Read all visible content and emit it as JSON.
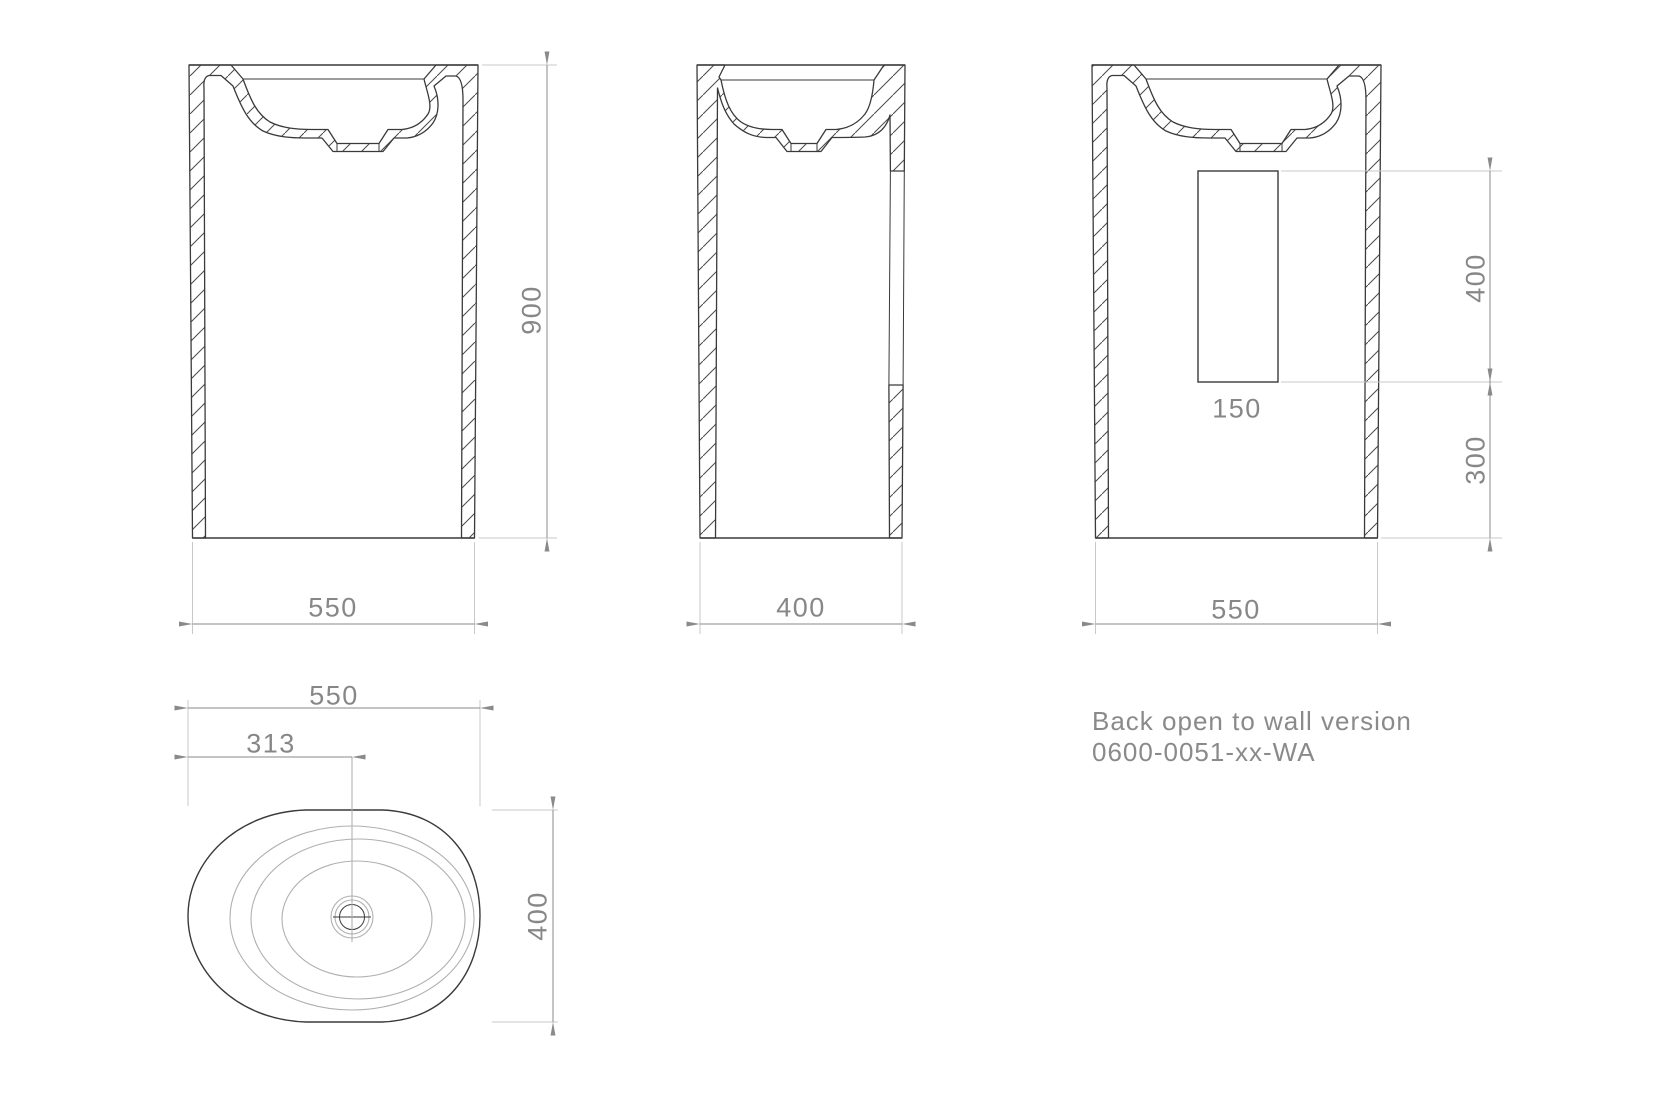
{
  "drawing": {
    "note": {
      "line1": "Back open to wall version",
      "line2": "0600-0051-xx-WA"
    },
    "views": {
      "front_elevation": {
        "width_label": "550",
        "height_label": "900"
      },
      "side_elevation": {
        "depth_label": "400"
      },
      "back_elevation": {
        "width_label": "550",
        "opening_width_label": "150",
        "opening_height_label": "400",
        "opening_bottom_offset_label": "300"
      },
      "plan_view": {
        "width_label": "550",
        "drain_offset_label": "313",
        "depth_label": "400"
      }
    },
    "colors": {
      "background": "#ffffff",
      "outline": "#3a3a3a",
      "soft_edge": "#b0b0b0",
      "dimension": "#8a8a8a",
      "extension": "#c9c9c9",
      "text": "#878787"
    }
  }
}
